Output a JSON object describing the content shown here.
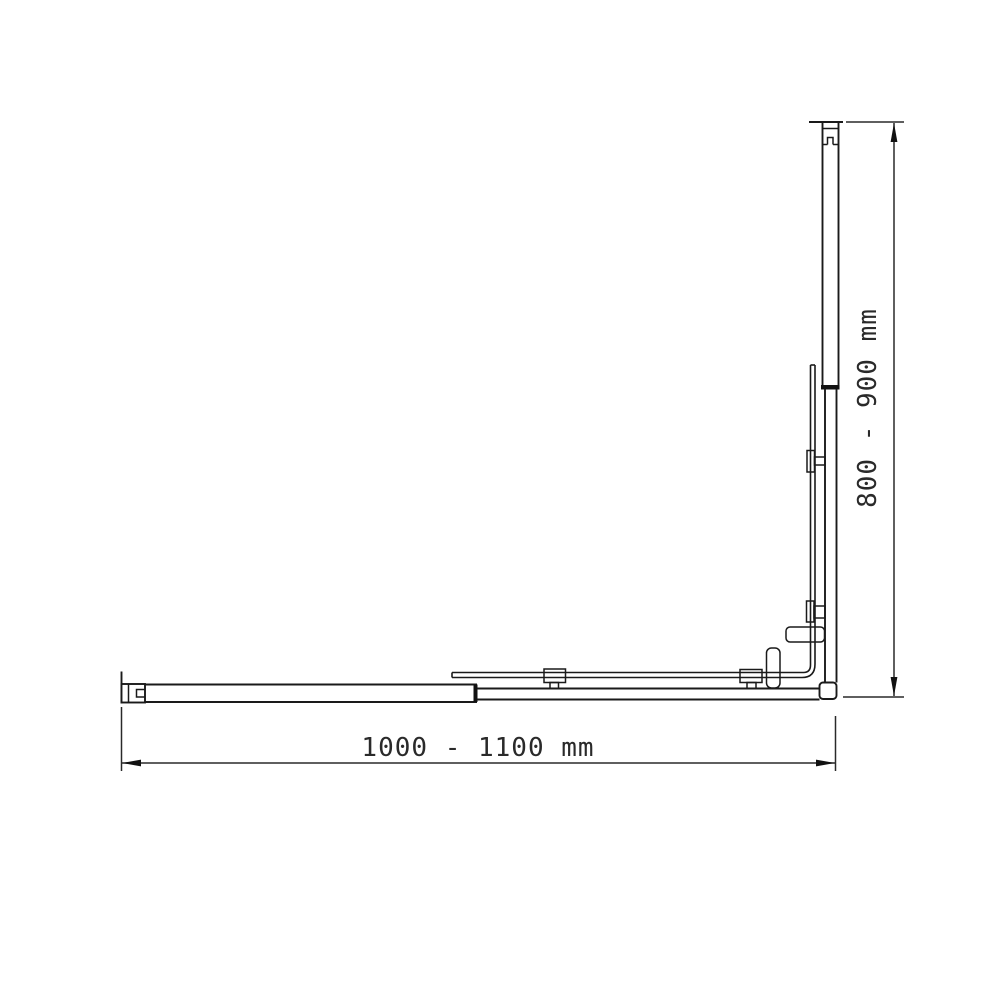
{
  "drawing": {
    "kind": "technical-dimension-drawing",
    "background_color": "#ffffff",
    "line_color": "#1a1a1a"
  },
  "dimensions": {
    "width": {
      "label": "1000 - 1100 mm"
    },
    "height": {
      "label": "800 - 900 mm"
    }
  }
}
